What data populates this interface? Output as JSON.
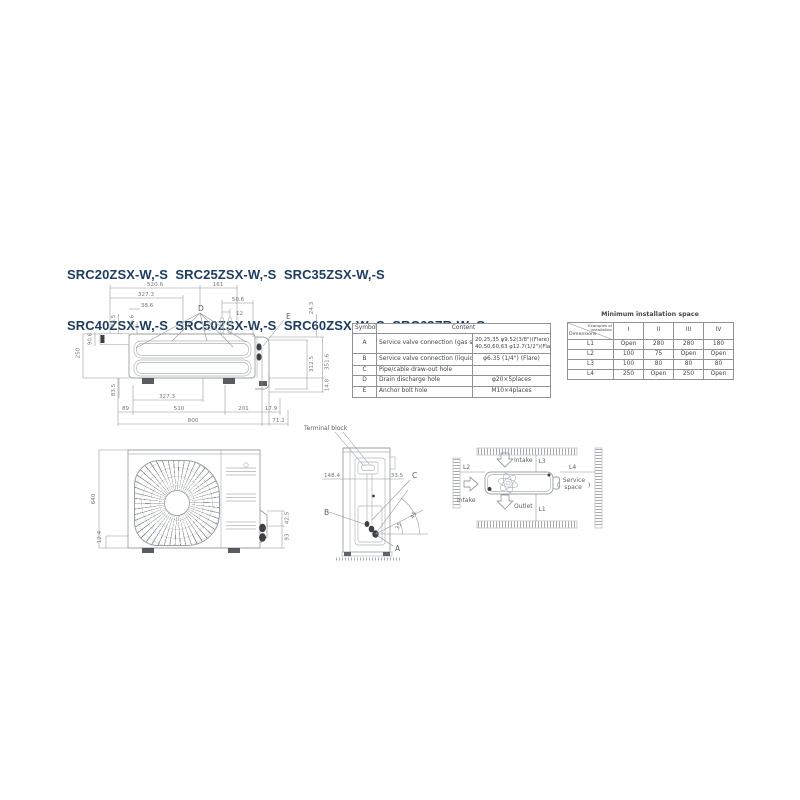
{
  "title": {
    "line1": "SRC20ZSX-W,-S  SRC25ZSX-W,-S  SRC35ZSX-W,-S",
    "line2": "SRC40ZSX-W,-S  SRC50ZSX-W,-S  SRC60ZSX-W,-S  SRC63ZR-W,-S"
  },
  "colors": {
    "title_navy": "#1d3d60",
    "line_gray": "#9ba0a3",
    "dim_text": "#74787c",
    "dark_fill": "#3e4043"
  },
  "top_view": {
    "labels": {
      "d": "D",
      "e": "E"
    },
    "dims": {
      "w5206": "520.6",
      "w161": "161",
      "w3273_top": "327.3",
      "w506": "50.6",
      "w12": "12",
      "w386": "38.6",
      "h435": "43.5",
      "h356": "35.6",
      "h906": "90.6",
      "h250": "250",
      "h243": "24.3",
      "h3516": "351.6",
      "h3125": "312.5",
      "h148": "14.8",
      "h835": "83.5",
      "w3273_bot": "327.3",
      "w89": "89",
      "w510": "510",
      "w201": "201",
      "w179": "17.9",
      "w800": "800",
      "w712": "71.2"
    }
  },
  "front_view": {
    "dims": {
      "h640": "640",
      "h124": "12.4",
      "h425": "42.5",
      "h93": "93"
    }
  },
  "side_view": {
    "terminal_block_label": "Terminal block",
    "labels": {
      "a": "A",
      "b": "B",
      "c": "C"
    },
    "dims": {
      "w1484": "148.4",
      "w335": "33.5",
      "angle_outer": "45",
      "angle_inner": "35"
    }
  },
  "install_diagram": {
    "l1": "L1",
    "l2": "L2",
    "l3": "L3",
    "l4": "L4",
    "intake_top": "Intake",
    "intake_left": "Intake",
    "outlet": "Outlet",
    "service_line1": "Service",
    "service_line2": "space",
    "paren_open": "(",
    "paren_close": ")"
  },
  "symbol_table": {
    "header_symbol": "Symbol",
    "header_content": "Content",
    "rows": [
      {
        "symbol": "A",
        "desc": "Service valve connection (gas side)",
        "value1": "20,25,35 φ9.52(3/8\")(Flare)",
        "value2": "40,50,60,63 φ12.7(1/2\")(Flare)"
      },
      {
        "symbol": "B",
        "desc": "Service valve connection (liquid side)",
        "value1": "φ6.35 (1/4\") (Flare)",
        "value2": ""
      },
      {
        "symbol": "C",
        "desc": "Pipe/cable draw-out hole",
        "value1": "",
        "value2": ""
      },
      {
        "symbol": "D",
        "desc": "Drain discharge hole",
        "value1": "φ20×5places",
        "value2": ""
      },
      {
        "symbol": "E",
        "desc": "Anchor bolt hole",
        "value1": "M10×4places",
        "value2": ""
      }
    ]
  },
  "space_table": {
    "title": "Minimum installation space",
    "corner_top1": "Examples of",
    "corner_top2": "installation",
    "corner_bottom": "Dimensions",
    "columns": [
      "I",
      "II",
      "III",
      "IV"
    ],
    "rows": [
      {
        "label": "L1",
        "values": [
          "Open",
          "280",
          "280",
          "180"
        ]
      },
      {
        "label": "L2",
        "values": [
          "100",
          "75",
          "Open",
          "Open"
        ]
      },
      {
        "label": "L3",
        "values": [
          "100",
          "80",
          "80",
          "80"
        ]
      },
      {
        "label": "L4",
        "values": [
          "250",
          "Open",
          "250",
          "Open"
        ]
      }
    ]
  }
}
